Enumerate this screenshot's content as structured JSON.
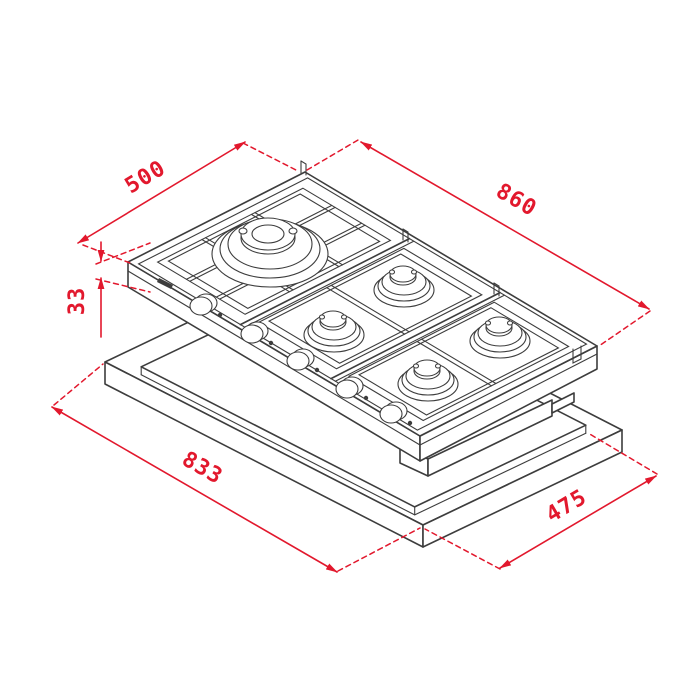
{
  "dimension_labels": {
    "hob_depth": "500",
    "hob_width": "860",
    "hob_height": "33",
    "cutout_length": "833",
    "cutout_width": "475"
  },
  "colors": {
    "dimension_red": "#e2182d",
    "drawing_line": "#3d3d3d",
    "background": "#ffffff"
  }
}
